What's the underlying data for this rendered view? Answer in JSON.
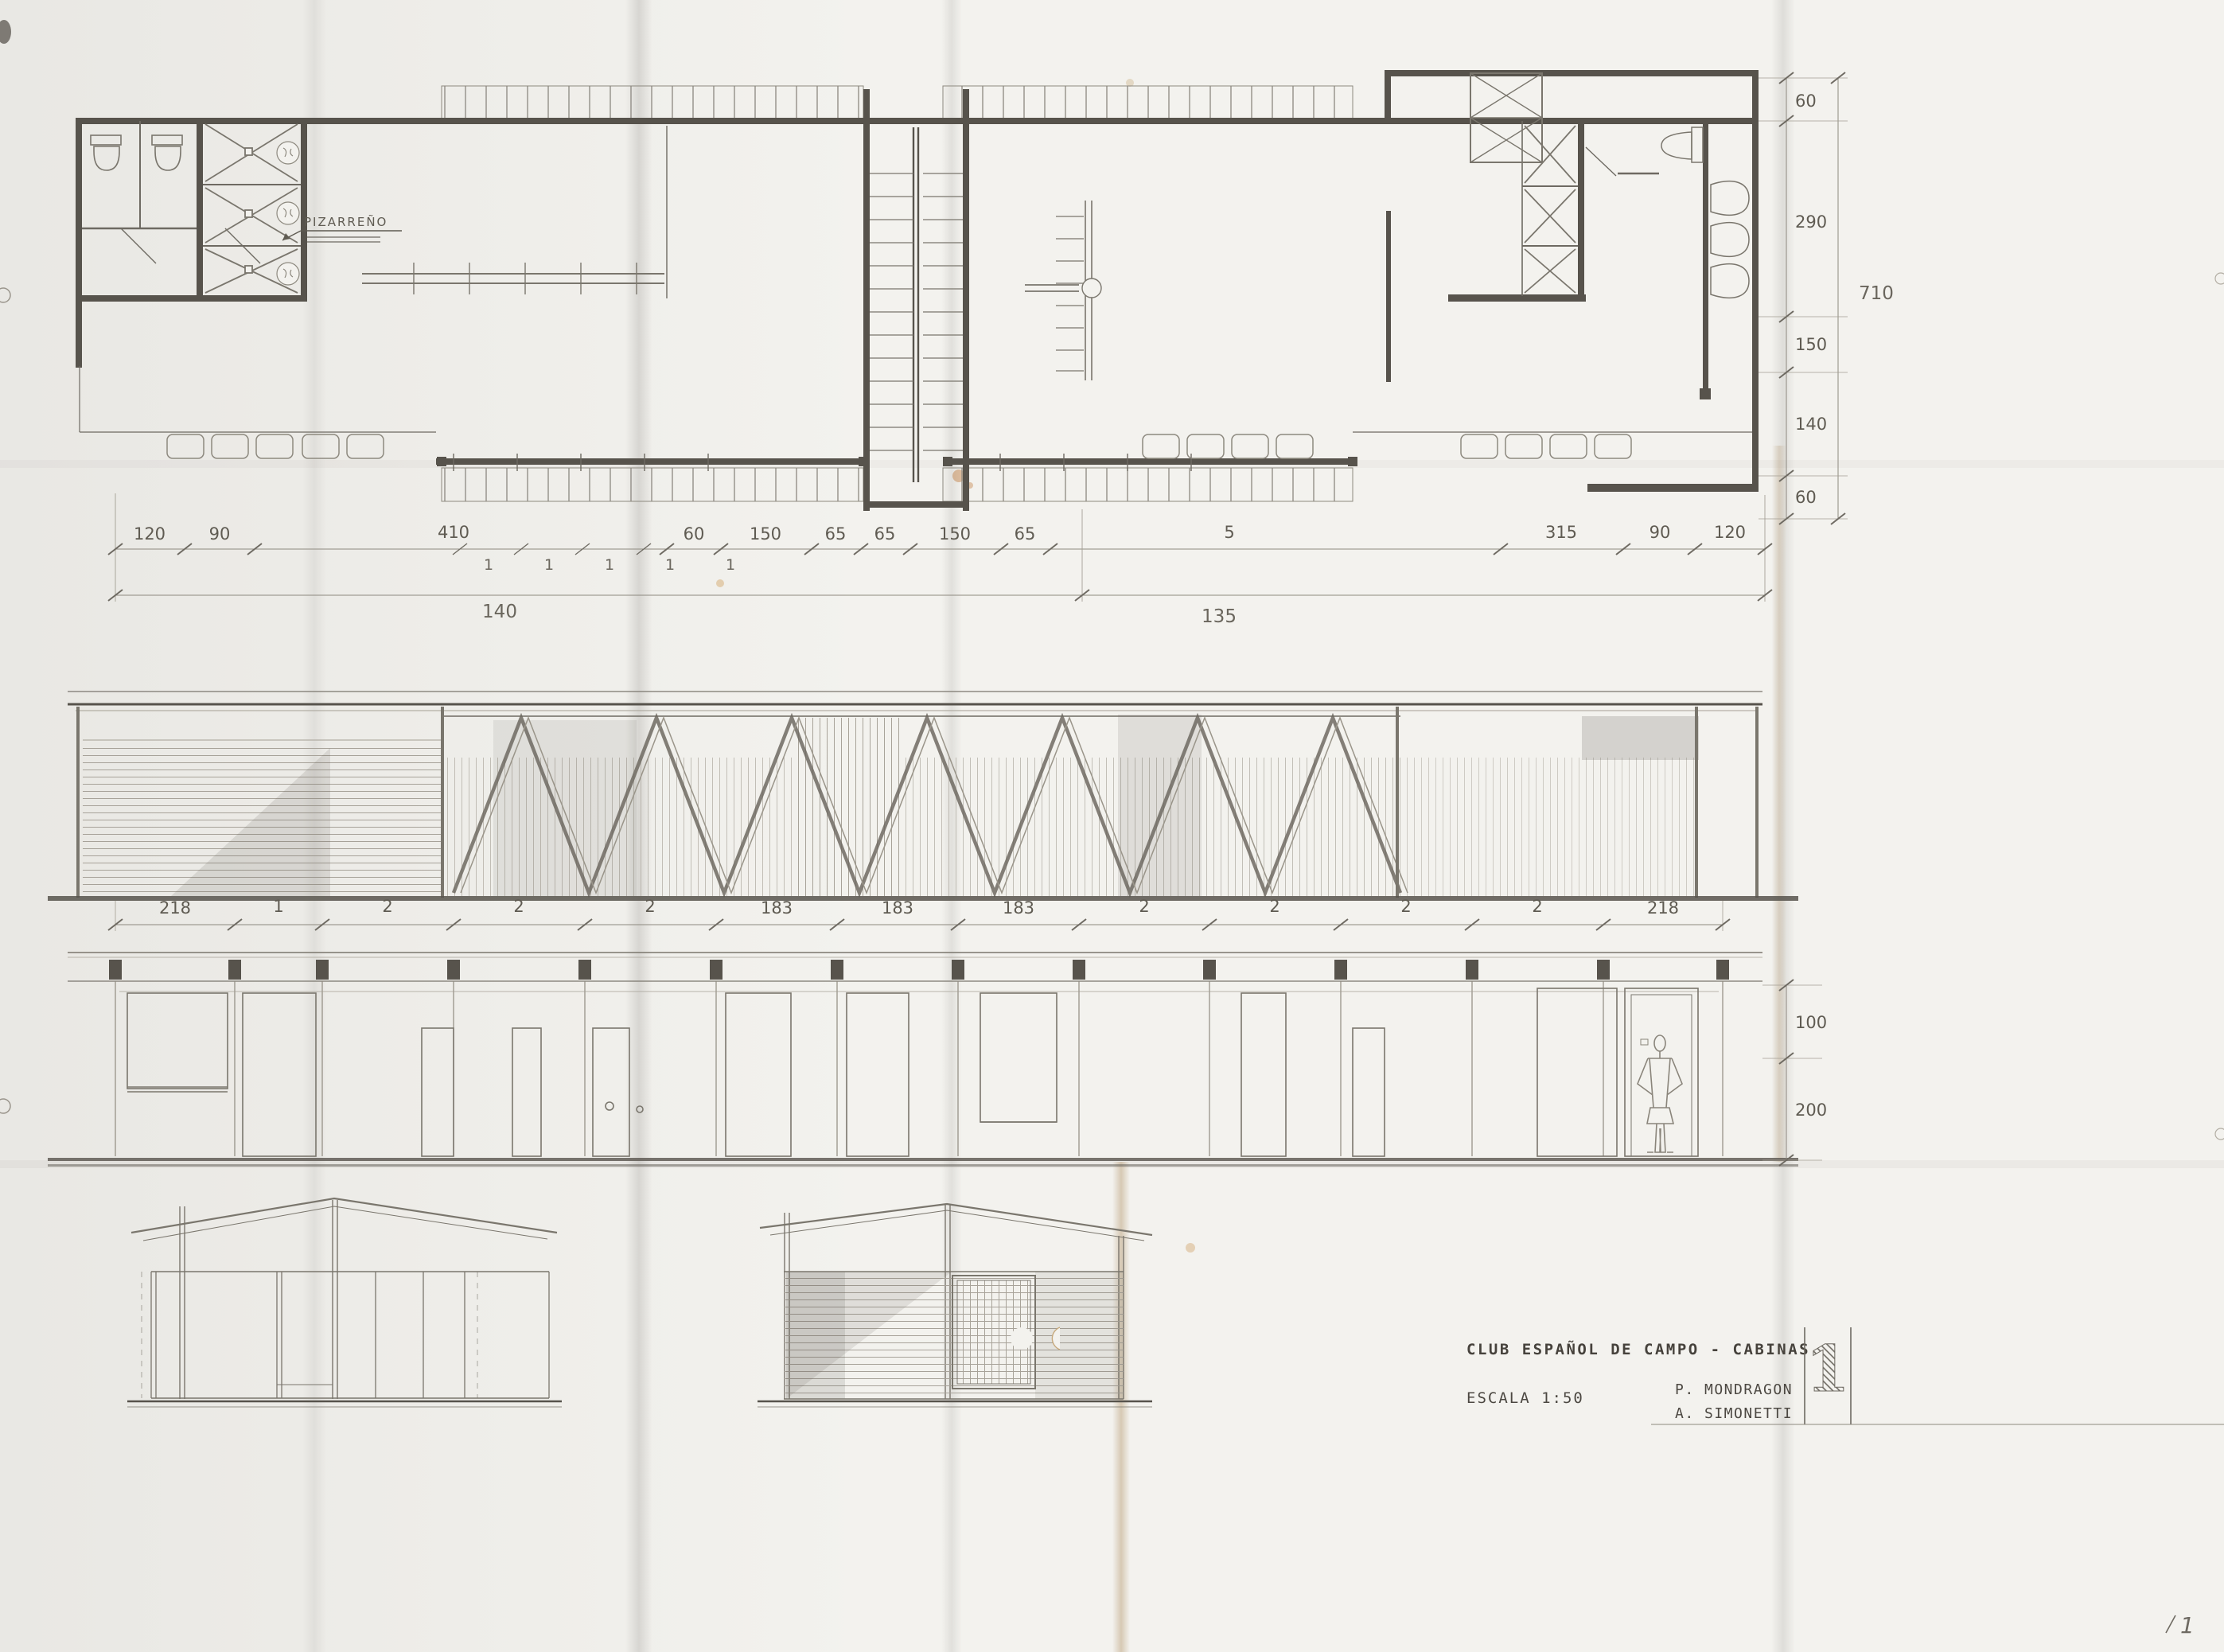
{
  "sheet": {
    "title": "CLUB ESPAÑOL DE CAMPO - CABINAS",
    "scale_label": "ESCALA 1:50",
    "authors": [
      "P. MONDRAGON",
      "A. SIMONETTI"
    ],
    "sheet_number": "1",
    "corner_mark": "1"
  },
  "plan": {
    "material_note": "PIZARREÑO",
    "dims_top": [
      "120",
      "90",
      "410",
      "60",
      "150",
      "65",
      "65",
      "150",
      "65",
      "5",
      "315",
      "90",
      "120"
    ],
    "dims_top_unit": [
      "1",
      "1",
      "1",
      "1",
      "1"
    ],
    "dims_totals": [
      "140",
      "135"
    ],
    "dims_right": [
      "60",
      "290",
      "150",
      "140",
      "60"
    ],
    "dims_right_total": "710"
  },
  "front_elevation": {
    "dims": [
      "218",
      "1",
      "2",
      "2",
      "2",
      "183",
      "183",
      "183",
      "2",
      "2",
      "2",
      "2",
      "218"
    ]
  },
  "rear_elevation": {
    "dims_right": [
      "100",
      "200"
    ]
  }
}
